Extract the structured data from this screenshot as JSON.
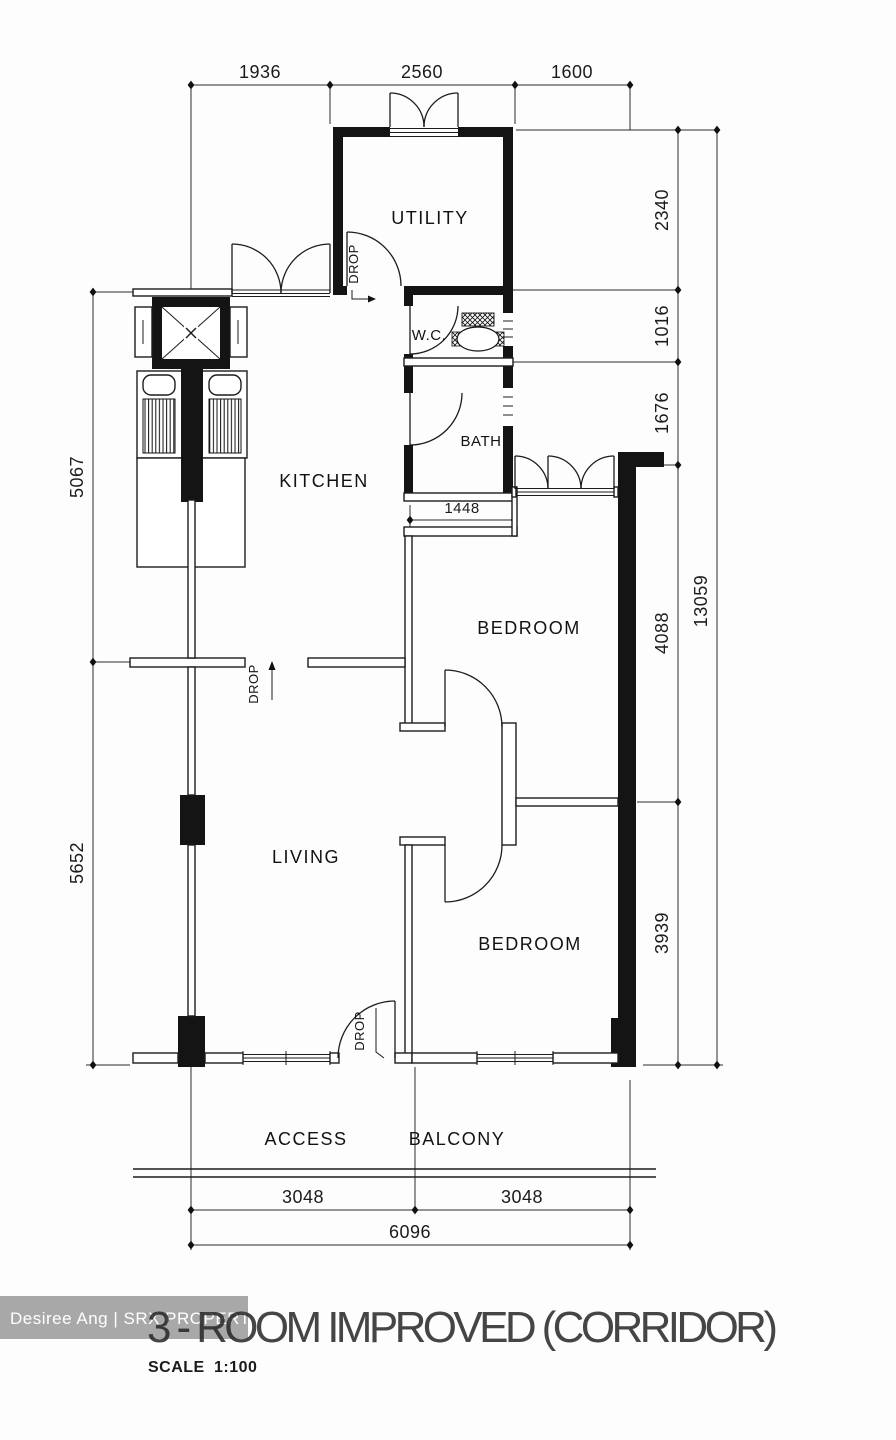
{
  "plan": {
    "rooms": {
      "utility": "UTILITY",
      "wc": "W.C.",
      "bath": "BATH",
      "kitchen": "KITCHEN",
      "bedroom1": "BEDROOM",
      "living": "LIVING",
      "bedroom2": "BEDROOM",
      "access": "ACCESS",
      "balcony": "BALCONY"
    },
    "drop_labels": {
      "utility": "DROP",
      "living": "DROP",
      "balcony": "DROP"
    },
    "dimensions": {
      "top": [
        "1936",
        "2560",
        "1600"
      ],
      "right": [
        "2340",
        "1016",
        "1676",
        "4088",
        "3939"
      ],
      "right_total": "13059",
      "left": [
        "5067",
        "5652"
      ],
      "interior": [
        "1448"
      ],
      "bottom": [
        "3048",
        "3048"
      ],
      "bottom_total": "6096"
    },
    "title": "3 - ROOM IMPROVED (CORRIDOR)",
    "scale_label": "SCALE",
    "scale_value": "1:100"
  },
  "watermark": {
    "text": "Desiree Ang | SRX PROPERTY",
    "bg": "#a8a8a8",
    "fg": "#ffffff"
  },
  "colors": {
    "line": "#1c1c1c",
    "bg": "#fdfdfd"
  }
}
